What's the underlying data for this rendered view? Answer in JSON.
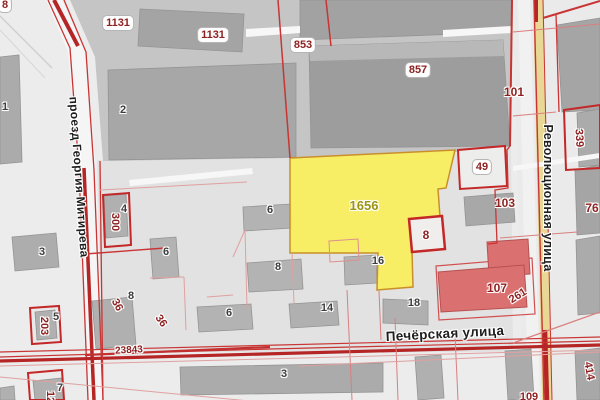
{
  "map_type": "cadastral-map",
  "streets": {
    "left": "проезд Георгия Митирева",
    "right": "Революционная улица",
    "bottom": "Печёрская улица"
  },
  "selected_parcel": {
    "number": "1656"
  },
  "parcel_labels": [
    {
      "text": "1131"
    },
    {
      "text": "1131"
    },
    {
      "text": "853"
    },
    {
      "text": "857"
    },
    {
      "text": "49"
    },
    {
      "text": "101"
    },
    {
      "text": "103"
    },
    {
      "text": "8"
    },
    {
      "text": "107"
    },
    {
      "text": "261"
    },
    {
      "text": "76"
    },
    {
      "text": "339"
    },
    {
      "text": "414"
    },
    {
      "text": "300"
    },
    {
      "text": "203"
    },
    {
      "text": "36"
    },
    {
      "text": "36"
    },
    {
      "text": "23843"
    },
    {
      "text": "12"
    },
    {
      "text": "109"
    },
    {
      "text": "8"
    }
  ],
  "building_labels": [
    {
      "text": "2"
    },
    {
      "text": "1"
    },
    {
      "text": "3"
    },
    {
      "text": "4"
    },
    {
      "text": "6"
    },
    {
      "text": "6"
    },
    {
      "text": "8"
    },
    {
      "text": "6"
    },
    {
      "text": "16"
    },
    {
      "text": "18"
    },
    {
      "text": "14"
    },
    {
      "text": "5"
    },
    {
      "text": "8"
    },
    {
      "text": "3"
    },
    {
      "text": "7"
    }
  ],
  "colors": {
    "background": "#ececec",
    "selected_parcel_fill": "#f8ef5a",
    "selected_parcel_border": "#c98f2b",
    "cadastral_line_red": "#c42727",
    "highlighted_building_fill": "#db7070",
    "road_fill": "#e8d795",
    "building_fill": "#acacac"
  }
}
